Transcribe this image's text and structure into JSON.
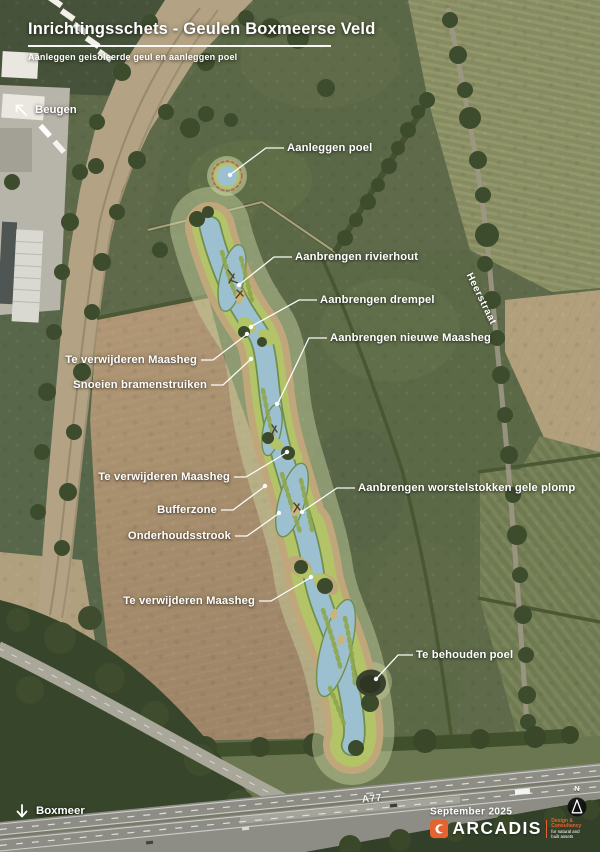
{
  "header": {
    "title": "Inrichtingsschets - Geulen Boxmeerse Veld",
    "subtitle": "Aanleggen geisoleerde geul en aanleggen poel"
  },
  "map": {
    "direction_labels": [
      {
        "id": "beugen",
        "label": "Beugen"
      },
      {
        "id": "boxmeer",
        "label": "Boxmeer"
      }
    ],
    "road_labels": {
      "heerstraat": "Heerstraat",
      "highway": "A77"
    },
    "annotations": [
      {
        "id": "aanleggen-poel",
        "label": "Aanleggen poel"
      },
      {
        "id": "aanbrengen-rivierhout",
        "label": "Aanbrengen rivierhout"
      },
      {
        "id": "aanbrengen-drempel",
        "label": "Aanbrengen drempel"
      },
      {
        "id": "aanbrengen-nieuwe-maasheg",
        "label": "Aanbrengen nieuwe Maasheg"
      },
      {
        "id": "te-verwijderen-maasheg-1",
        "label": "Te verwijderen Maasheg"
      },
      {
        "id": "snoeien-bramenstruiken",
        "label": "Snoeien bramenstruiken"
      },
      {
        "id": "te-verwijderen-maasheg-2",
        "label": "Te verwijderen Maasheg"
      },
      {
        "id": "bufferzone",
        "label": "Bufferzone"
      },
      {
        "id": "onderhoudsstrook",
        "label": "Onderhoudsstrook"
      },
      {
        "id": "aanbrengen-worstelstokken",
        "label": "Aanbrengen worstelstokken gele plomp"
      },
      {
        "id": "te-verwijderen-maasheg-3",
        "label": "Te verwijderen Maasheg"
      },
      {
        "id": "te-behouden-poel",
        "label": "Te behouden poel"
      }
    ]
  },
  "footer": {
    "date": "September 2025",
    "logo": {
      "name": "ARCADIS",
      "tagline_line1": "Design & Consultancy",
      "tagline_line2": "for natural and",
      "tagline_line3": "built assets"
    },
    "north_indicator": "N"
  },
  "colors": {
    "water": "#9cc0d0",
    "bank_vegetation": "#b3c368",
    "maintenance_strip": "#c0a77b",
    "buffer_halo": "#cbd7a3",
    "arcadis_orange": "#e4632e",
    "label_text": "#ffffff"
  }
}
